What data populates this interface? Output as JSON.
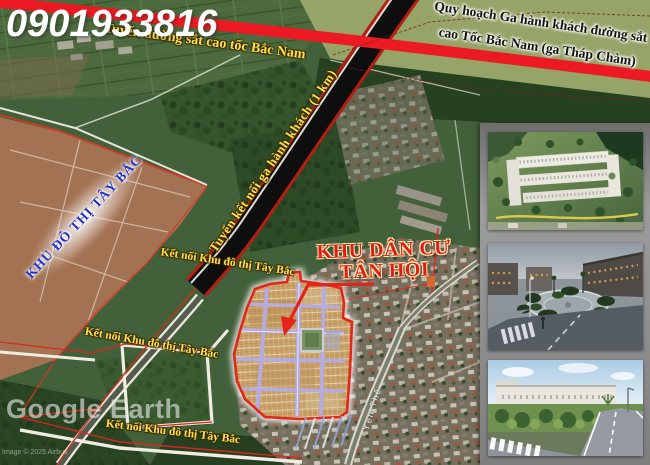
{
  "map": {
    "phone": "0901933816",
    "railway_label": "Tuyến đường sắt cao tốc Bắc Nam",
    "station_plan_line1": "Quy hoạch Ga hành khách đường sắt",
    "station_plan_line2": "cao Tốc Bắc Nam (ga Tháp Chàm)",
    "connector_label": "Tuyến kết nối ga hành khách (1 km)",
    "urban_area_label": "KHU ĐÔ THỊ TÂY BẮC",
    "project_line1": "KHU DÂN CƯ",
    "project_line2": "TÂN HỘI",
    "connection_label_top": "Kết nối Khu đô thị Tây Bắc",
    "connection_label_mid": "Kết nối Khu đô thị Tây Bắc",
    "connection_label_bottom": "Kết nối Khu đô thị Tây Bắc",
    "street_label": "Yên Thế",
    "watermark": "Google Earth",
    "copyright": "Image © 2025 Airbus"
  },
  "colors": {
    "railway_red": "#ec1a22",
    "highlight_yellow": "#ffe24a",
    "plan_blue": "#2431c8",
    "project_red": "#e01c1c",
    "plot_outline": "#e42618"
  },
  "gallery": {
    "items": [
      {
        "name": "aerial-masterplan-render"
      },
      {
        "name": "evening-streetscape-render"
      },
      {
        "name": "daytime-streetscape-render"
      }
    ]
  }
}
